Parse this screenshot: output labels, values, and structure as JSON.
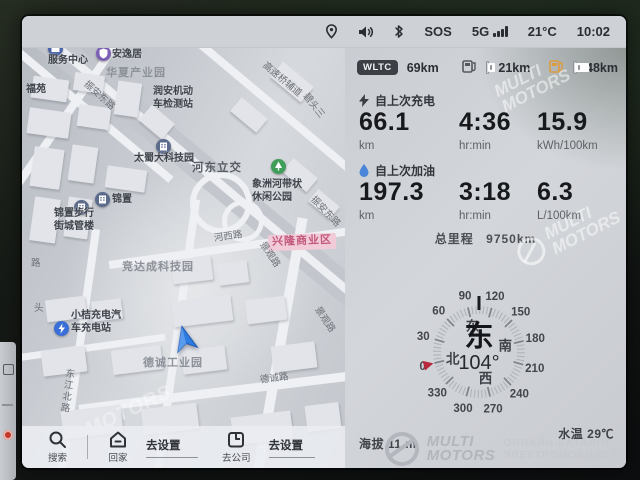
{
  "status_bar": {
    "sos": "SOS",
    "network": "5G",
    "temperature": "21°C",
    "time": "10:02",
    "icons": [
      "location",
      "volume",
      "bluetooth",
      "signal"
    ]
  },
  "map": {
    "labels": [
      {
        "text": "服务中心",
        "cls": "poi",
        "x": 26,
        "y": 7,
        "r": 0
      },
      {
        "text": "安逸居",
        "cls": "poi",
        "x": 90,
        "y": 1,
        "r": 0
      },
      {
        "text": "华夏产业园",
        "cls": "area",
        "x": 84,
        "y": 19,
        "r": 0
      },
      {
        "text": "福苑",
        "cls": "poi",
        "x": 4,
        "y": 36,
        "r": 0
      },
      {
        "text": "振安东路",
        "cls": "road",
        "x": 58,
        "y": 42,
        "r": 42
      },
      {
        "text": "润安机动\n车检测站",
        "cls": "poi",
        "x": 131,
        "y": 38,
        "r": 0
      },
      {
        "text": "高速桥辅道",
        "cls": "road",
        "x": 236,
        "y": 26,
        "r": 40
      },
      {
        "text": "碧头三",
        "cls": "road",
        "x": 277,
        "y": 52,
        "r": 52
      },
      {
        "text": "太蜀大科技园",
        "cls": "poi",
        "x": 112,
        "y": 105,
        "r": 0
      },
      {
        "text": "锦置",
        "cls": "poi",
        "x": 90,
        "y": 146,
        "r": 0
      },
      {
        "text": "锦置步行\n街城管楼",
        "cls": "poi",
        "x": 32,
        "y": 160,
        "r": 0
      },
      {
        "text": "河东立交",
        "cls": "big",
        "x": 170,
        "y": 113,
        "r": 0
      },
      {
        "text": "象洲河带状\n休闲公园",
        "cls": "poi",
        "x": 230,
        "y": 131,
        "r": 0
      },
      {
        "text": "振安东路",
        "cls": "road",
        "x": 284,
        "y": 158,
        "r": 46
      },
      {
        "text": "河西路",
        "cls": "road",
        "x": 192,
        "y": 183,
        "r": -8
      },
      {
        "text": "兴隆商业区",
        "cls": "pink",
        "x": 246,
        "y": 186,
        "r": -2
      },
      {
        "text": "竞达成科技园",
        "cls": "area",
        "x": 100,
        "y": 213,
        "r": 0
      },
      {
        "text": "景观路",
        "cls": "road",
        "x": 233,
        "y": 201,
        "r": 56
      },
      {
        "text": "景观路",
        "cls": "road",
        "x": 288,
        "y": 266,
        "r": 56
      },
      {
        "text": "路",
        "cls": "road",
        "x": 9,
        "y": 210,
        "r": 0
      },
      {
        "text": "头",
        "cls": "road",
        "x": 12,
        "y": 255,
        "r": 0
      },
      {
        "text": "小桔充电汽\n车充电站",
        "cls": "poi",
        "x": 49,
        "y": 262,
        "r": 0
      },
      {
        "text": "德诚工业园",
        "cls": "area",
        "x": 121,
        "y": 309,
        "r": 0
      },
      {
        "text": "东江北路",
        "cls": "roadv",
        "x": 38,
        "y": 320,
        "r": 8
      },
      {
        "text": "德诚路",
        "cls": "road",
        "x": 238,
        "y": 325,
        "r": -7
      }
    ],
    "poi_icons": [
      {
        "type": "bank",
        "x": 26,
        "y": -7
      },
      {
        "type": "shield",
        "x": 74,
        "y": -2
      },
      {
        "type": "building",
        "x": 134,
        "y": 91
      },
      {
        "type": "building",
        "x": 52,
        "y": 152
      },
      {
        "type": "building",
        "x": 73,
        "y": 144
      },
      {
        "type": "park",
        "x": 249,
        "y": 111
      },
      {
        "type": "charge",
        "x": 32,
        "y": 273
      }
    ],
    "bottom_bar": {
      "search_label": "搜索",
      "home_label": "回家",
      "home_action": "去设置",
      "company_label": "去公司",
      "company_action": "去设置"
    }
  },
  "panel": {
    "range": {
      "wltc_badge": "WLTC",
      "wltc_value": "69km",
      "electric_value": "21km",
      "fuel_value": "48km"
    },
    "since_charge": {
      "title": "自上次充电",
      "stats": [
        {
          "value": "66.1",
          "unit": "km"
        },
        {
          "value": "4:36",
          "unit": "hr:min"
        },
        {
          "value": "15.9",
          "unit": "kWh/100km"
        }
      ]
    },
    "since_refuel": {
      "title": "自上次加油",
      "stats": [
        {
          "value": "197.3",
          "unit": "km"
        },
        {
          "value": "3:18",
          "unit": "hr:min"
        },
        {
          "value": "6.3",
          "unit": "L/100km"
        }
      ]
    },
    "odometer": {
      "label": "总里程",
      "value": "9750km"
    },
    "compass": {
      "heading_degrees": 104,
      "heading_text": "东",
      "degree_display": "104°",
      "tick_numbers": [
        0,
        30,
        60,
        90,
        120,
        150,
        180,
        210,
        240,
        270,
        300,
        330
      ],
      "cardinals": [
        {
          "label": "北",
          "deg": 0
        },
        {
          "label": "东",
          "deg": 90
        },
        {
          "label": "南",
          "deg": 180
        },
        {
          "label": "西",
          "deg": 270
        }
      ],
      "marker_color": "#b8293d"
    },
    "altitude": {
      "label": "海拔",
      "value": "11 m"
    },
    "water_temp": {
      "label": "水温",
      "value": "29℃"
    }
  },
  "watermark": {
    "brand_line1": "MULTI",
    "brand_line2": "MOTORS",
    "tagline_line1": "ОНЛАЙН-КАТАЛОГ",
    "tagline_line2": "ЭЛЕКТРОМОБИЛЕЙ",
    "map_text": "MOTORS"
  },
  "colors": {
    "accent_blue": "#2f7ce0",
    "fuel_orange": "#dd9c3f",
    "marker_red": "#b8293d",
    "pink_zone": "#f2cbd8"
  }
}
